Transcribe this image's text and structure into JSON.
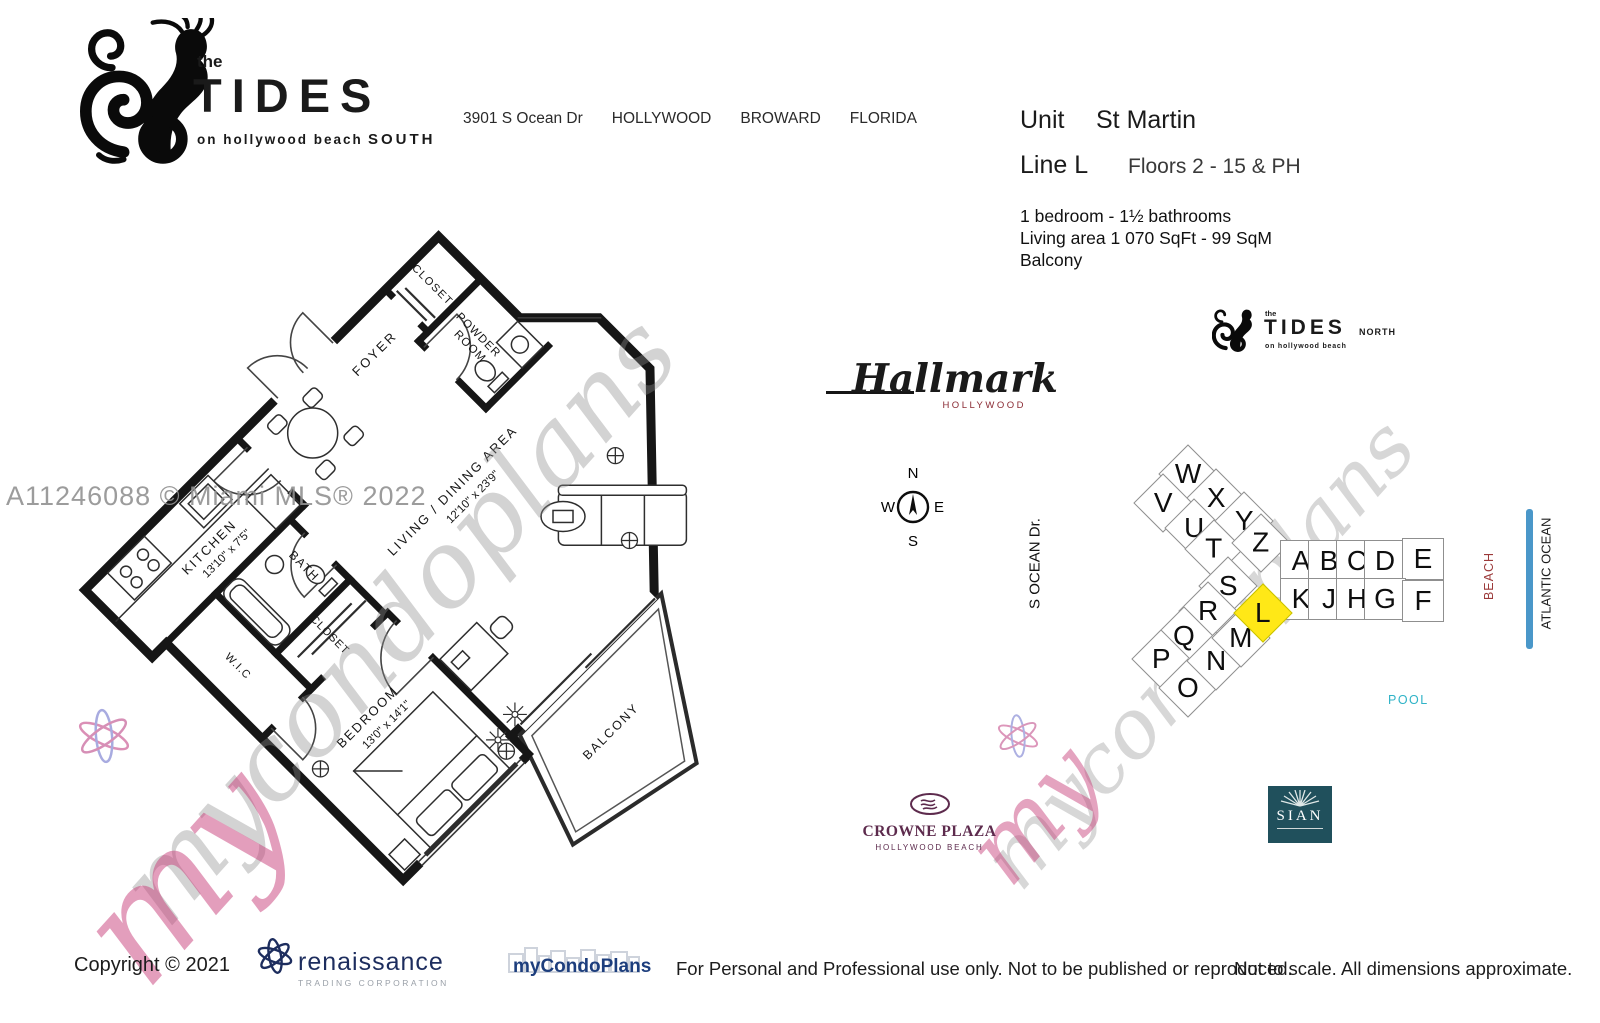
{
  "header": {
    "logo": {
      "the": "the",
      "name": "TIDES",
      "tagline": "on hollywood beach",
      "region": "SOUTH"
    },
    "address": {
      "street": "3901 S Ocean Dr",
      "city": "HOLLYWOOD",
      "county": "BROWARD",
      "state": "FLORIDA"
    }
  },
  "unit_info": {
    "unit_label": "Unit",
    "unit_name": "St Martin",
    "line_label": "Line L",
    "floors": "Floors 2 - 15 & PH",
    "bedrooms": "1 bedroom - 1½ bathrooms",
    "living_area": "Living area  1 070  SqFt - 99  SqM",
    "feature": "Balcony"
  },
  "floor_plan": {
    "foyer": "FOYER",
    "entry_closet": "CLOSET",
    "powder_line1": "POWDER",
    "powder_line2": "ROOM",
    "kitchen": "KITCHEN",
    "kitchen_dim": "13'10\" x 7'5\"",
    "living": "LIVING / DINING AREA",
    "living_dim": "12'10\" x 23'9\"",
    "bath": "BATH",
    "closet": "CLOSET",
    "wic": "W.I.C",
    "bedroom": "BEDROOM",
    "bedroom_dim": "13'0\" x 14'1\"",
    "balcony": "BALCONY"
  },
  "watermarks": {
    "mls": "A11246088 © Miami MLS® 2022",
    "script_left": "mycondoplans",
    "script_right": "mycondoplans",
    "script_my_left": "my",
    "script_my_right": "my"
  },
  "compass": {
    "n": "N",
    "e": "E",
    "s": "S",
    "w": "W"
  },
  "neighbors": {
    "hallmark": {
      "name": "Hallmark",
      "sub": "HOLLYWOOD"
    },
    "tides_north": {
      "the": "the",
      "name": "TIDES",
      "region": "NORTH",
      "tagline": "on hollywood beach"
    },
    "crowne": {
      "name": "CROWNE PLAZA",
      "sub": "HOLLYWOOD BEACH"
    },
    "sian": {
      "name": "SIAN"
    },
    "street": "S OCEAN Dr.",
    "pool": "POOL",
    "beach": "BEACH",
    "ocean": "ATLANTIC OCEAN"
  },
  "site_map": {
    "highlight_color": "#ffe817",
    "cells": [
      {
        "letter": "W"
      },
      {
        "letter": "V"
      },
      {
        "letter": "X"
      },
      {
        "letter": "U"
      },
      {
        "letter": "Y"
      },
      {
        "letter": "T"
      },
      {
        "letter": "Z"
      },
      {
        "letter": "S"
      },
      {
        "letter": "R"
      },
      {
        "letter": "Q"
      },
      {
        "letter": "P"
      },
      {
        "letter": "O"
      },
      {
        "letter": "N"
      },
      {
        "letter": "M"
      },
      {
        "letter": "L",
        "highlighted": true
      },
      {
        "letter": "A"
      },
      {
        "letter": "B"
      },
      {
        "letter": "C"
      },
      {
        "letter": "D"
      },
      {
        "letter": "E"
      },
      {
        "letter": "K"
      },
      {
        "letter": "J"
      },
      {
        "letter": "H"
      },
      {
        "letter": "G"
      },
      {
        "letter": "F"
      }
    ]
  },
  "footer": {
    "copyright": "Copyright © 2021",
    "renaissance": {
      "name": "renaissance",
      "sub": "TRADING CORPORATION"
    },
    "mycondoplans": "myCondoPlans",
    "usage": "For Personal and Professional use only.  Not to be published or reproduced.",
    "disclaimer": "Not to scale.  All dimensions approximate."
  }
}
